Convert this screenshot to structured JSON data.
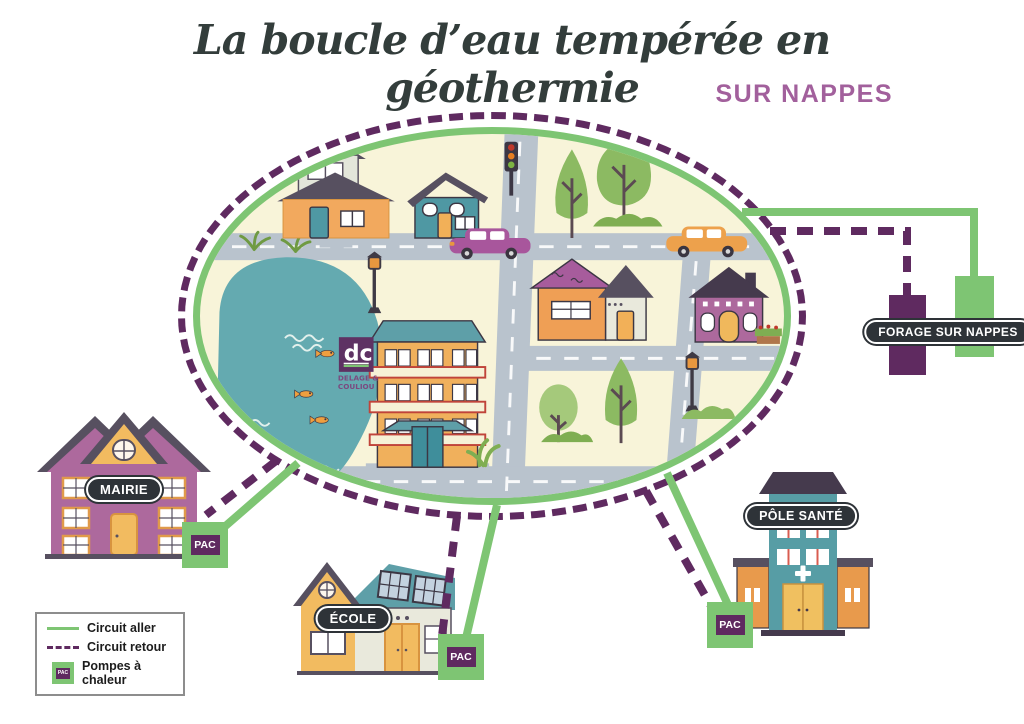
{
  "title": "La boucle d’eau tempérée en géothermie",
  "subtitle": "SUR NAPPES",
  "buildings": {
    "mairie": {
      "label": "MAIRIE",
      "pac": "PAC"
    },
    "ecole": {
      "label": "ÉCOLE",
      "pac": "PAC"
    },
    "pole_sante": {
      "label": "PÔLE SANTÉ",
      "pac": "PAC"
    },
    "forage": {
      "label": "FORAGE SUR NAPPES"
    }
  },
  "logo": {
    "monogram": "dc",
    "name_line1": "DELAGE &",
    "name_line2": "COULIOU"
  },
  "legend": {
    "items": [
      {
        "label": "Circuit aller"
      },
      {
        "label": "Circuit retour"
      },
      {
        "label": "Pompes à chaleur",
        "icon_text": "PAC"
      }
    ]
  },
  "colors": {
    "circuit_aller_green": "#7ec573",
    "circuit_retour_purple": "#5f2a60",
    "map_background": "#f8f4d9",
    "road_gray": "#b9c3cd",
    "pond_teal": "#64aab0",
    "title_ink": "#333d3b",
    "subtitle_purple": "#a2609c",
    "label_pill_bg": "#2e3338"
  }
}
